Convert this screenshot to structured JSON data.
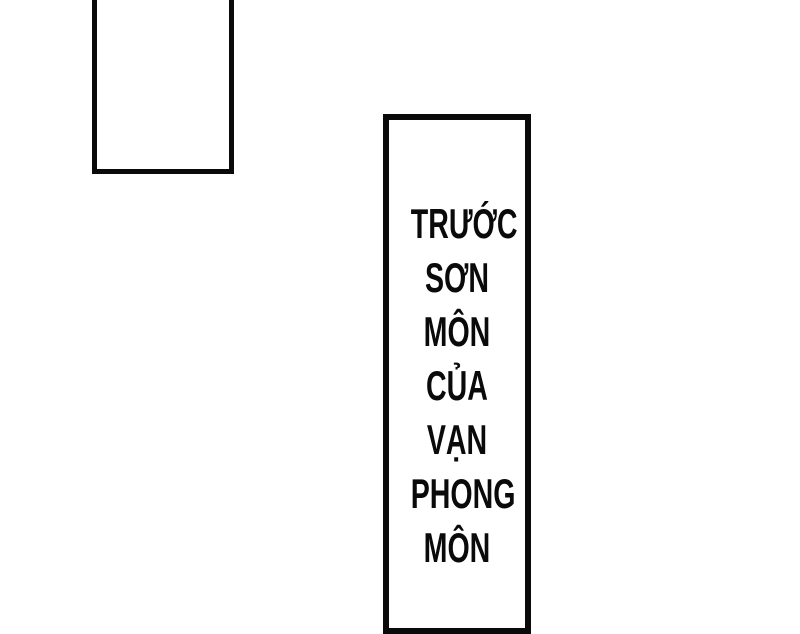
{
  "page": {
    "type": "comic-page",
    "background_color": "#ffffff",
    "ink_color": "#0a0a0a"
  },
  "panels": {
    "empty_panel": {
      "content": ""
    }
  },
  "caption": {
    "full_text": "TRƯỚC SƠN MÔN CỦA VẠN PHONG MÔN",
    "lines": [
      "TRƯỚC",
      "SƠN",
      "MÔN",
      "CỦA",
      "VẠN",
      "PHONG",
      "MÔN"
    ]
  }
}
